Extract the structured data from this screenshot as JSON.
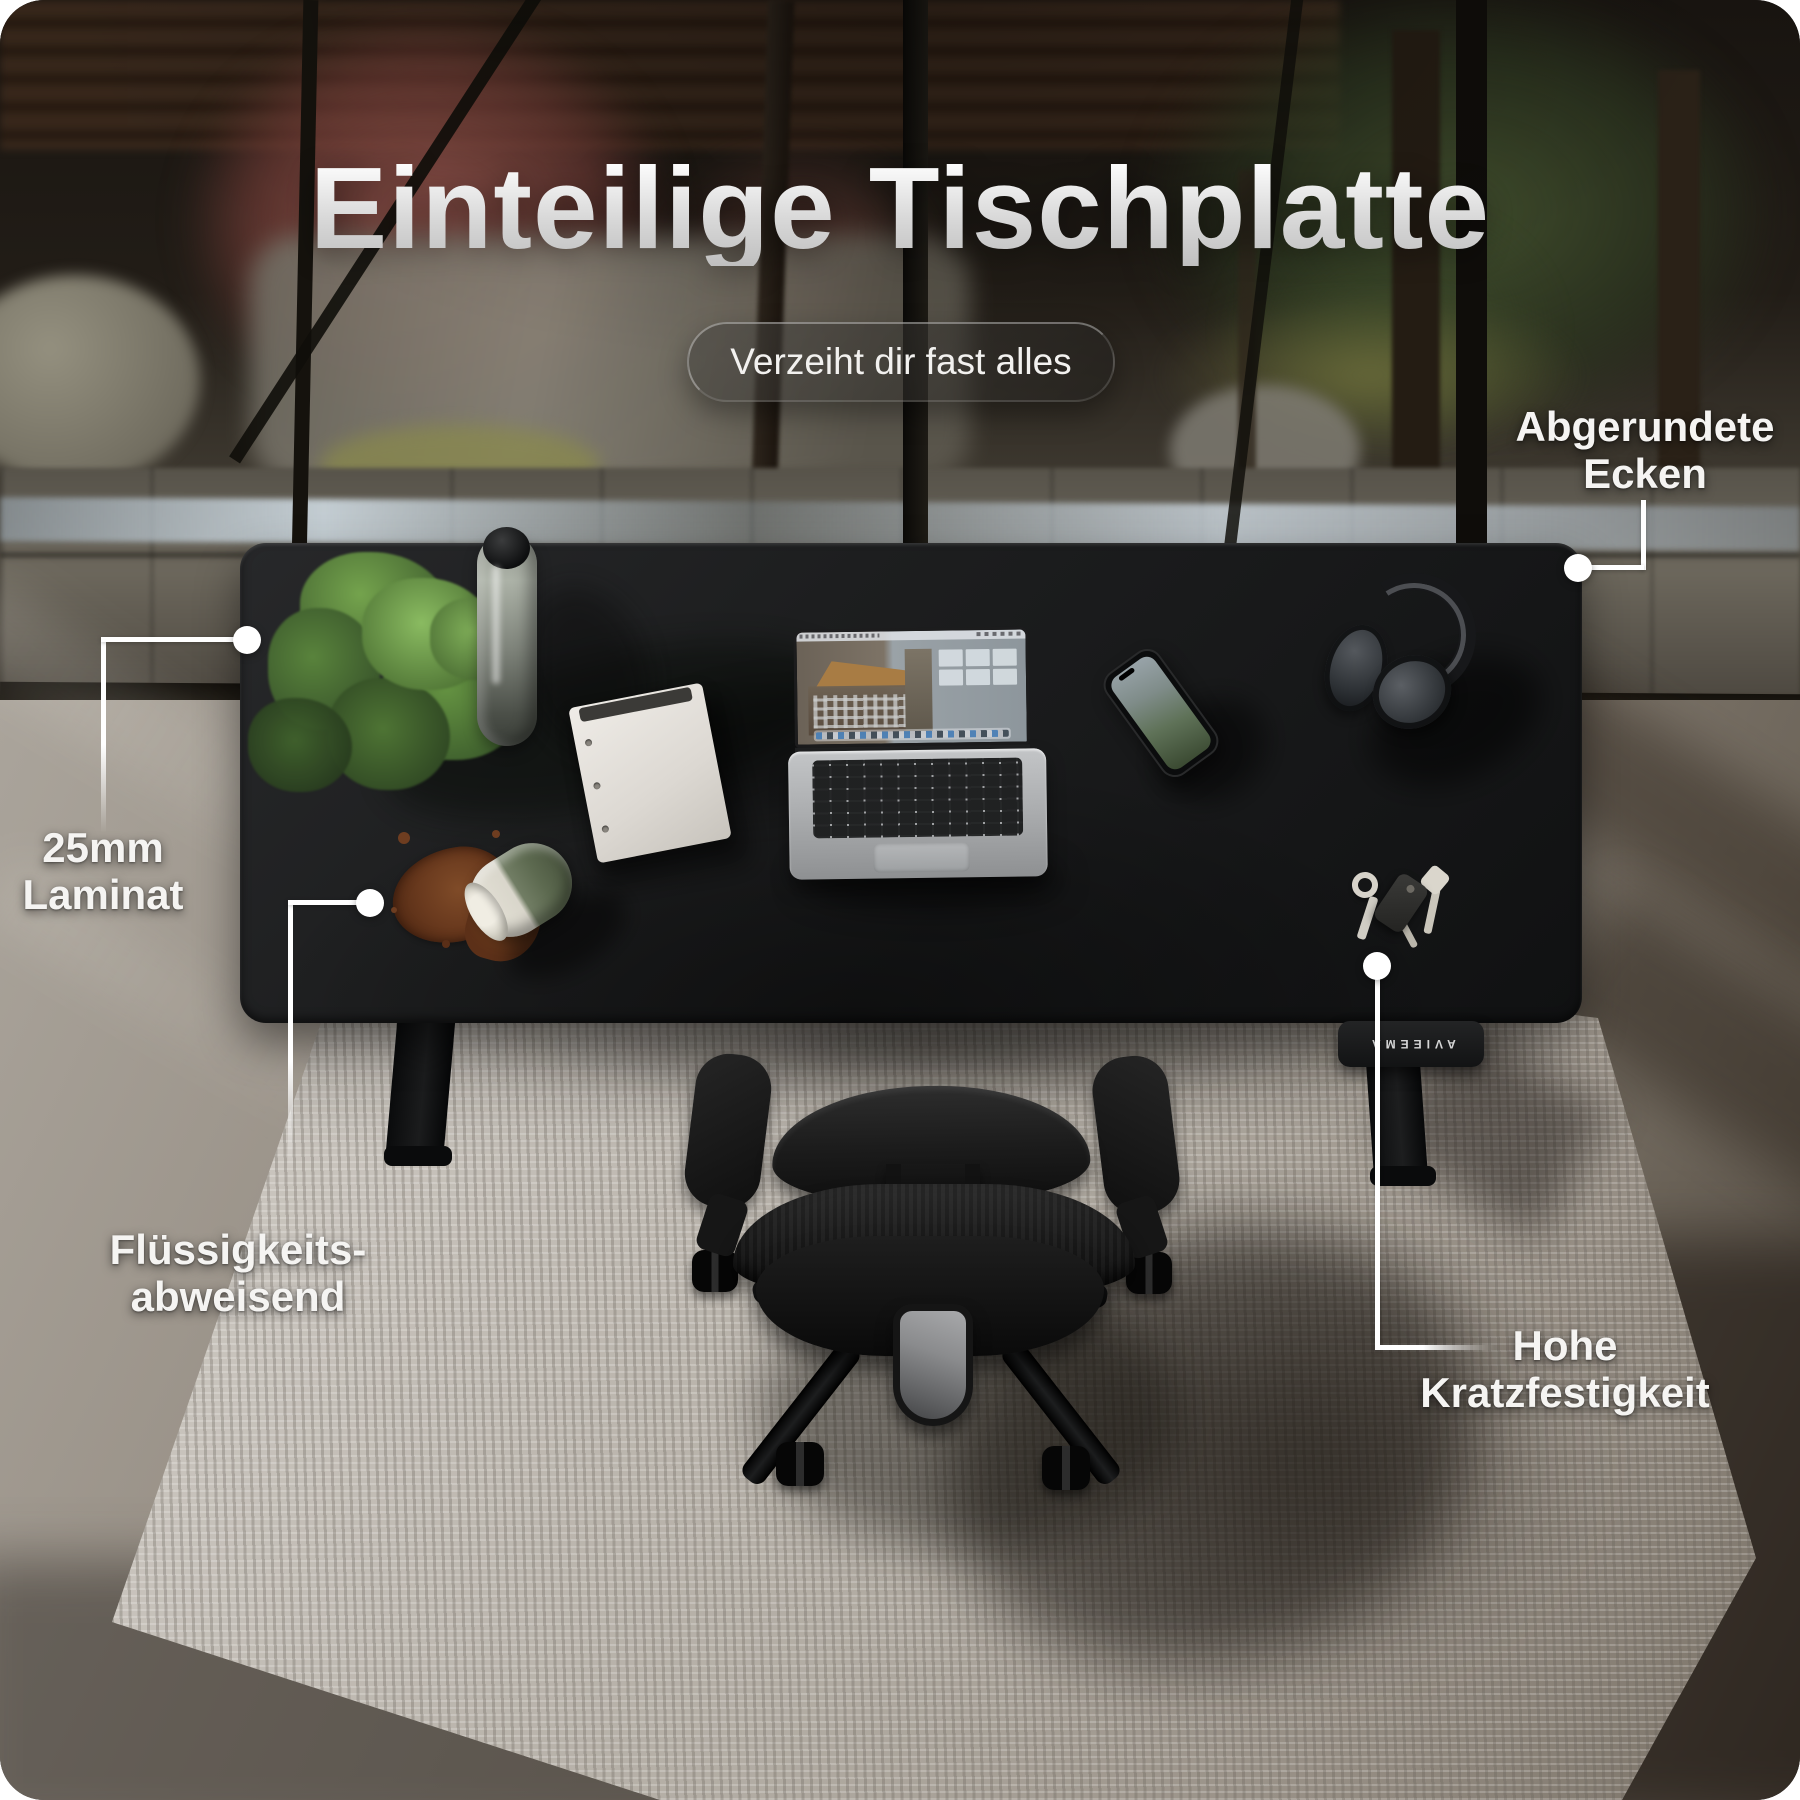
{
  "header": {
    "title": "Einteilige Tischplatte",
    "badge": "Verzeiht dir fast alles"
  },
  "callouts": {
    "rounded_corners": {
      "line1": "Abgerundete",
      "line2": "Ecken"
    },
    "laminate": {
      "line1": "25mm",
      "line2": "Laminat"
    },
    "liquid_repellent": {
      "line1": "Flüssigkeits-",
      "line2": "abweisend"
    },
    "scratch_resistance": {
      "line1": "Hohe",
      "line2": "Kratzfestigkeit"
    }
  },
  "desk": {
    "controller_glyphs": "AVIEEMA"
  },
  "colors": {
    "label_text": "#f5f4f2",
    "leader_line": "#ffffff",
    "desk_top": "#1d1e1f",
    "rug": "#c7c3bc",
    "spill": "#6a3a1e",
    "title_text": "#e9e9e9"
  }
}
